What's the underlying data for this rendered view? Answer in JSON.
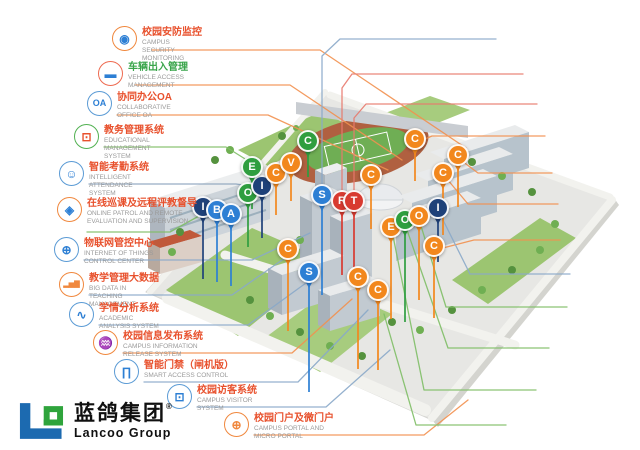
{
  "brand": {
    "name_cn": "蓝鸽集团",
    "name_en": "Lancoo Group",
    "reg_mark": "®",
    "logo_blue": "#1c6ab0",
    "logo_green": "#2fa43c"
  },
  "callouts": {
    "left": [
      {
        "id": "campus-security-monitoring",
        "title": "校园安防监控",
        "subtitle": "CAMPUS SECURITY MONITORING",
        "icon": "cctv-camera-icon",
        "circle": "#f0883e",
        "icon_color": "#2d7fd4",
        "title_color": "#e8512d",
        "pos": [
          125,
          39
        ]
      },
      {
        "id": "vehicle-access-management",
        "title": "车辆出入管理",
        "subtitle": "VEHICLE ACCESS MANAGEMENT",
        "icon": "car-icon",
        "circle": "#ee6a50",
        "icon_color": "#2d7fd4",
        "title_color": "#3aa54b",
        "pos": [
          111,
          74
        ]
      },
      {
        "id": "collaborative-office-oa",
        "title": "协同办公OA",
        "subtitle": "COLLABORATIVE OFFICE OA",
        "icon": "oa-icon",
        "circle": "#5b9bd5",
        "icon_color": "#2d7fd4",
        "title_color": "#e8512d",
        "pos": [
          100,
          104
        ]
      },
      {
        "id": "educational-management-system",
        "title": "教务管理系统",
        "subtitle": "EDUCATIONAL MANAGEMENT SYSTEM",
        "icon": "monitor-icon",
        "circle": "#52b152",
        "icon_color": "#e8512d",
        "title_color": "#e8512d",
        "pos": [
          87,
          137
        ]
      },
      {
        "id": "intelligent-attendance-system",
        "title": "智能考勤系统",
        "subtitle": "INTELLIGENT ATTENDANCE SYSTEM",
        "icon": "robot-icon",
        "circle": "#5b9bd5",
        "icon_color": "#2d7fd4",
        "title_color": "#e8512d",
        "pos": [
          72,
          174
        ]
      },
      {
        "id": "online-patrol-remote-evaluation",
        "title": "在线巡课及远程评教督导",
        "subtitle": "ONLINE PATROL AND REMOTE EVALUATION AND SUPERVISION",
        "icon": "shield-icon",
        "circle": "#f0883e",
        "icon_color": "#2d7fd4",
        "title_color": "#e8512d",
        "pos": [
          70,
          210
        ]
      },
      {
        "id": "iot-control-center",
        "title": "物联网管控中心",
        "subtitle": "INTERNET OF THINGS CONTROL CENTER",
        "icon": "network-globe-icon",
        "circle": "#5b9bd5",
        "icon_color": "#2d7fd4",
        "title_color": "#e8512d",
        "pos": [
          67,
          250
        ]
      },
      {
        "id": "big-data-in-teaching-management",
        "title": "教学管理大数据",
        "subtitle": "BIG DATA IN TEACHING MANAGEMENT",
        "icon": "bar-chart-icon",
        "circle": "#f0883e",
        "icon_color": "#f0883e",
        "title_color": "#e8512d",
        "pos": [
          72,
          285
        ]
      },
      {
        "id": "academic-analysis-system",
        "title": "学情分析系统",
        "subtitle": "ACADEMIC ANALYSIS SYSTEM",
        "icon": "trend-chart-icon",
        "circle": "#5b9bd5",
        "icon_color": "#2d7fd4",
        "title_color": "#e8512d",
        "pos": [
          82,
          315
        ]
      },
      {
        "id": "campus-information-release-system",
        "title": "校园信息发布系统",
        "subtitle": "CAMPUS INFORMATION RELEASE SYSTEM",
        "icon": "antenna-icon",
        "circle": "#f0883e",
        "icon_color": "#f0883e",
        "title_color": "#e8512d",
        "pos": [
          106,
          343
        ]
      },
      {
        "id": "smart-access-control",
        "title": "智能门禁（闸机版）",
        "subtitle": "SMART ACCESS CONTROL",
        "icon": "gate-icon",
        "circle": "#5b9bd5",
        "icon_color": "#2d7fd4",
        "title_color": "#e8512d",
        "pos": [
          127,
          372
        ]
      },
      {
        "id": "campus-visitor-system",
        "title": "校园访客系统",
        "subtitle": "CAMPUS VISITOR SYSTEM",
        "icon": "visitor-screen-icon",
        "circle": "#5b9bd5",
        "icon_color": "#2d7fd4",
        "title_color": "#e8512d",
        "pos": [
          180,
          397
        ]
      },
      {
        "id": "campus-portal-and-micro-portal",
        "title": "校园门户及微门户",
        "subtitle": "CAMPUS PORTAL AND MICRO PORTAL",
        "icon": "globe-icon",
        "circle": "#f0883e",
        "icon_color": "#f0883e",
        "title_color": "#e8512d",
        "pos": [
          237,
          425
        ]
      }
    ],
    "right": [
      {
        "id": "smart-course-selection",
        "title": "智能选课排课",
        "subtitle": "SMART COURSE SELECTION",
        "icon": "schedule-icon",
        "circle": "#5b9bd5",
        "icon_color": "#f0883e",
        "title_color": "#e8512d",
        "pos": [
          510,
          29
        ]
      },
      {
        "id": "results-management-and-general-evaluation",
        "title": "成绩管理及总评",
        "subtitle": "RESULTS MANAGEMENT AND GENERAL EVALUATION",
        "icon": "score-100-icon",
        "circle": "#e05252",
        "icon_color": "#6b87a8",
        "title_color": "#e04f52",
        "pos": [
          537,
          64
        ]
      },
      {
        "id": "integrated-teaching-rain-platform",
        "title": "一体化教学雨平台",
        "subtitle": "INTEGRATED TEACHING RAIN PLATFORM",
        "icon": "books-icon",
        "circle": "#e05252",
        "icon_color": "#c4384f",
        "title_color": "#e04f52",
        "pos": [
          551,
          94
        ]
      },
      {
        "id": "canteen-hygiene-and-safety-monitoring",
        "title": "食堂卫生安全监控",
        "subtitle": "CANTEEN HYGIENE AND SAFETY MONITORING",
        "icon": "shield-eye-icon",
        "circle": "#f0883e",
        "icon_color": "#f0883e",
        "title_color": "#e8512d",
        "pos": [
          559,
          126
        ]
      },
      {
        "id": "campus-webcast",
        "title": "校园网络广播",
        "subtitle": "CAMPUS WEBCAST",
        "icon": "radio-icon",
        "circle": "#4aa3df",
        "icon_color": "#4aa3df",
        "title_color": "#e8512d",
        "pos": [
          566,
          163
        ]
      },
      {
        "id": "card-consumption",
        "title": "一卡通水电消费",
        "subtitle": "CARD CONSUMPTION",
        "icon": "card-icon",
        "circle": "#f0883e",
        "icon_color": "#f0b43e",
        "title_color": "#e8512d",
        "pos": [
          572,
          194
        ]
      },
      {
        "id": "campus-assets-and-warranty",
        "title": "校园资产管理及报修",
        "subtitle": "CAMPUS ASSETS AND WARRANTY",
        "icon": "repair-tools-icon",
        "circle": "#f0883e",
        "icon_color": "#2d7fd4",
        "title_color": "#e8512d",
        "pos": [
          574,
          230
        ]
      },
      {
        "id": "intelligent-sink-management-system",
        "title": "智能宿管系统",
        "subtitle": "INTELLIGENT SINK MANAGEMENT SYSTEM",
        "icon": "building-icon",
        "circle": "#5b9bd5",
        "icon_color": "#2d7fd4",
        "title_color": "#e8512d",
        "pos": [
          584,
          264
        ]
      },
      {
        "id": "cloud-network-wisdom-classroom",
        "title": "云网络智慧教室",
        "subtitle": "CLOUD NETWORK WISDOM CLASSROOM",
        "icon": "cloud-icon",
        "circle": "#e86a50",
        "icon_color": "#2d7fd4",
        "title_color": "#e04f52",
        "pos": [
          581,
          297
        ]
      },
      {
        "id": "multimedia-smart-classroom",
        "title": "多媒体智慧教室",
        "subtitle": "MULTIMEDIA SMART CLASSROOM",
        "icon": "classroom-icon",
        "circle": "#52b152",
        "icon_color": "#3aa54b",
        "title_color": "#e8512d",
        "pos": [
          563,
          338
        ]
      },
      {
        "id": "online-classroom-live-broadcast-system",
        "title": "网上课堂直播点播系统",
        "subtitle": "ONLINE CLASSROOM LIVE BROADCAST SYSTEM",
        "icon": "video-play-icon",
        "circle": "#52b152",
        "icon_color": "#f0a53e",
        "title_color": "#e04f52",
        "pos": [
          550,
          380
        ]
      },
      {
        "id": "e-banner-system",
        "title": "电子班牌系统",
        "subtitle": "E-BANNER",
        "icon": "e-banner-icon",
        "circle": "#52b152",
        "icon_color": "#3aa54b",
        "title_color": "#e04f52",
        "pos": [
          520,
          415
        ]
      }
    ]
  },
  "pin_colors": {
    "navy": "#1e4179",
    "blue": "#2d7fd4",
    "green": "#2f9e3f",
    "orange": "#f2871d",
    "red": "#d83a30"
  },
  "pins": [
    {
      "letter": "I",
      "color": "navy",
      "x": 203,
      "y": 207,
      "stem": 60
    },
    {
      "letter": "B",
      "color": "blue",
      "x": 217,
      "y": 210,
      "stem": 60
    },
    {
      "letter": "A",
      "color": "blue",
      "x": 231,
      "y": 214,
      "stem": 60
    },
    {
      "letter": "O",
      "color": "green",
      "x": 248,
      "y": 193,
      "stem": 42
    },
    {
      "letter": "I",
      "color": "navy",
      "x": 262,
      "y": 186,
      "stem": 40
    },
    {
      "letter": "E",
      "color": "green",
      "x": 252,
      "y": 167,
      "stem": 30
    },
    {
      "letter": "C",
      "color": "orange",
      "x": 276,
      "y": 173,
      "stem": 30
    },
    {
      "letter": "V",
      "color": "orange",
      "x": 291,
      "y": 163,
      "stem": 26
    },
    {
      "letter": "C",
      "color": "green",
      "x": 308,
      "y": 141,
      "stem": 24
    },
    {
      "letter": "S",
      "color": "blue",
      "x": 322,
      "y": 195,
      "stem": 88
    },
    {
      "letter": "R",
      "color": "red",
      "x": 342,
      "y": 201,
      "stem": 62
    },
    {
      "letter": "T",
      "color": "red",
      "x": 354,
      "y": 201,
      "stem": 62
    },
    {
      "letter": "C",
      "color": "orange",
      "x": 371,
      "y": 175,
      "stem": 42
    },
    {
      "letter": "C",
      "color": "orange",
      "x": 415,
      "y": 139,
      "stem": 30
    },
    {
      "letter": "C",
      "color": "orange",
      "x": 458,
      "y": 155,
      "stem": 40
    },
    {
      "letter": "C",
      "color": "orange",
      "x": 443,
      "y": 173,
      "stem": 50
    },
    {
      "letter": "I",
      "color": "navy",
      "x": 438,
      "y": 208,
      "stem": 42
    },
    {
      "letter": "E",
      "color": "orange",
      "x": 391,
      "y": 227,
      "stem": 80
    },
    {
      "letter": "O",
      "color": "green",
      "x": 405,
      "y": 220,
      "stem": 90
    },
    {
      "letter": "O",
      "color": "orange",
      "x": 419,
      "y": 216,
      "stem": 72
    },
    {
      "letter": "C",
      "color": "orange",
      "x": 434,
      "y": 246,
      "stem": 60
    },
    {
      "letter": "C",
      "color": "orange",
      "x": 288,
      "y": 249,
      "stem": 70
    },
    {
      "letter": "S",
      "color": "blue",
      "x": 309,
      "y": 272,
      "stem": 108
    },
    {
      "letter": "C",
      "color": "orange",
      "x": 358,
      "y": 277,
      "stem": 80
    },
    {
      "letter": "C",
      "color": "orange",
      "x": 378,
      "y": 290,
      "stem": 68
    }
  ]
}
